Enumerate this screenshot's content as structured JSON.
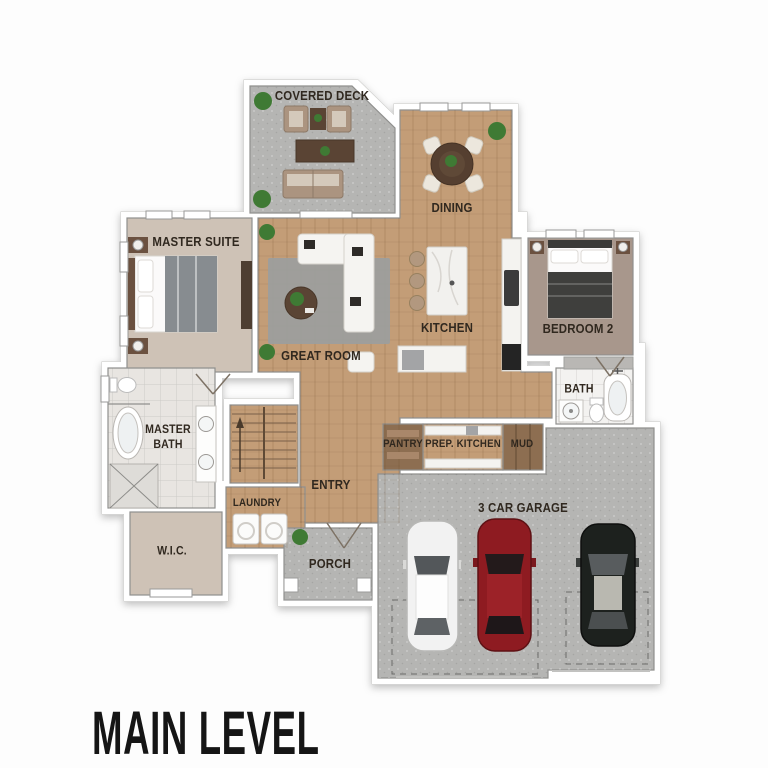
{
  "title": "MAIN LEVEL",
  "rooms": {
    "covered_deck": "COVERED DECK",
    "dining": "DINING",
    "master_suite": "MASTER SUITE",
    "great_room": "GREAT ROOM",
    "kitchen": "KITCHEN",
    "bedroom_2": "BEDROOM 2",
    "bath": "BATH",
    "master_bath": "MASTER BATH",
    "wic": "W.I.C.",
    "laundry": "LAUNDRY",
    "entry": "ENTRY",
    "pantry": "PANTRY",
    "prep_kitchen": "PREP. KITCHEN",
    "mud": "MUD",
    "garage": "3 CAR GARAGE",
    "porch": "PORCH"
  },
  "garage_cars": [
    "white",
    "red",
    "black"
  ],
  "colors": {
    "wood": "#c39d77",
    "concrete": "#b5b5b3",
    "master_floor": "#cec2b6",
    "bedroom2_floor": "#a8978c",
    "tile_white": "#f3f2f0",
    "tile_gray": "#e8e5e1",
    "cabinet_wood": "#8d6e51",
    "rug": "#9b9f9e",
    "sofa_white": "#f5f4f1",
    "deck_sofa": "#ab9480",
    "furn_dark": "#5a4434",
    "blanket_gray": "#878c90",
    "blanket_dark": "#3f3f3d",
    "stool": "#b2987f",
    "plant": "#3f7a34",
    "car_white": "#f2f2f2",
    "car_red": "#8e1b21",
    "car_black": "#1d211e",
    "label": "#30281f",
    "title": "#151515"
  }
}
